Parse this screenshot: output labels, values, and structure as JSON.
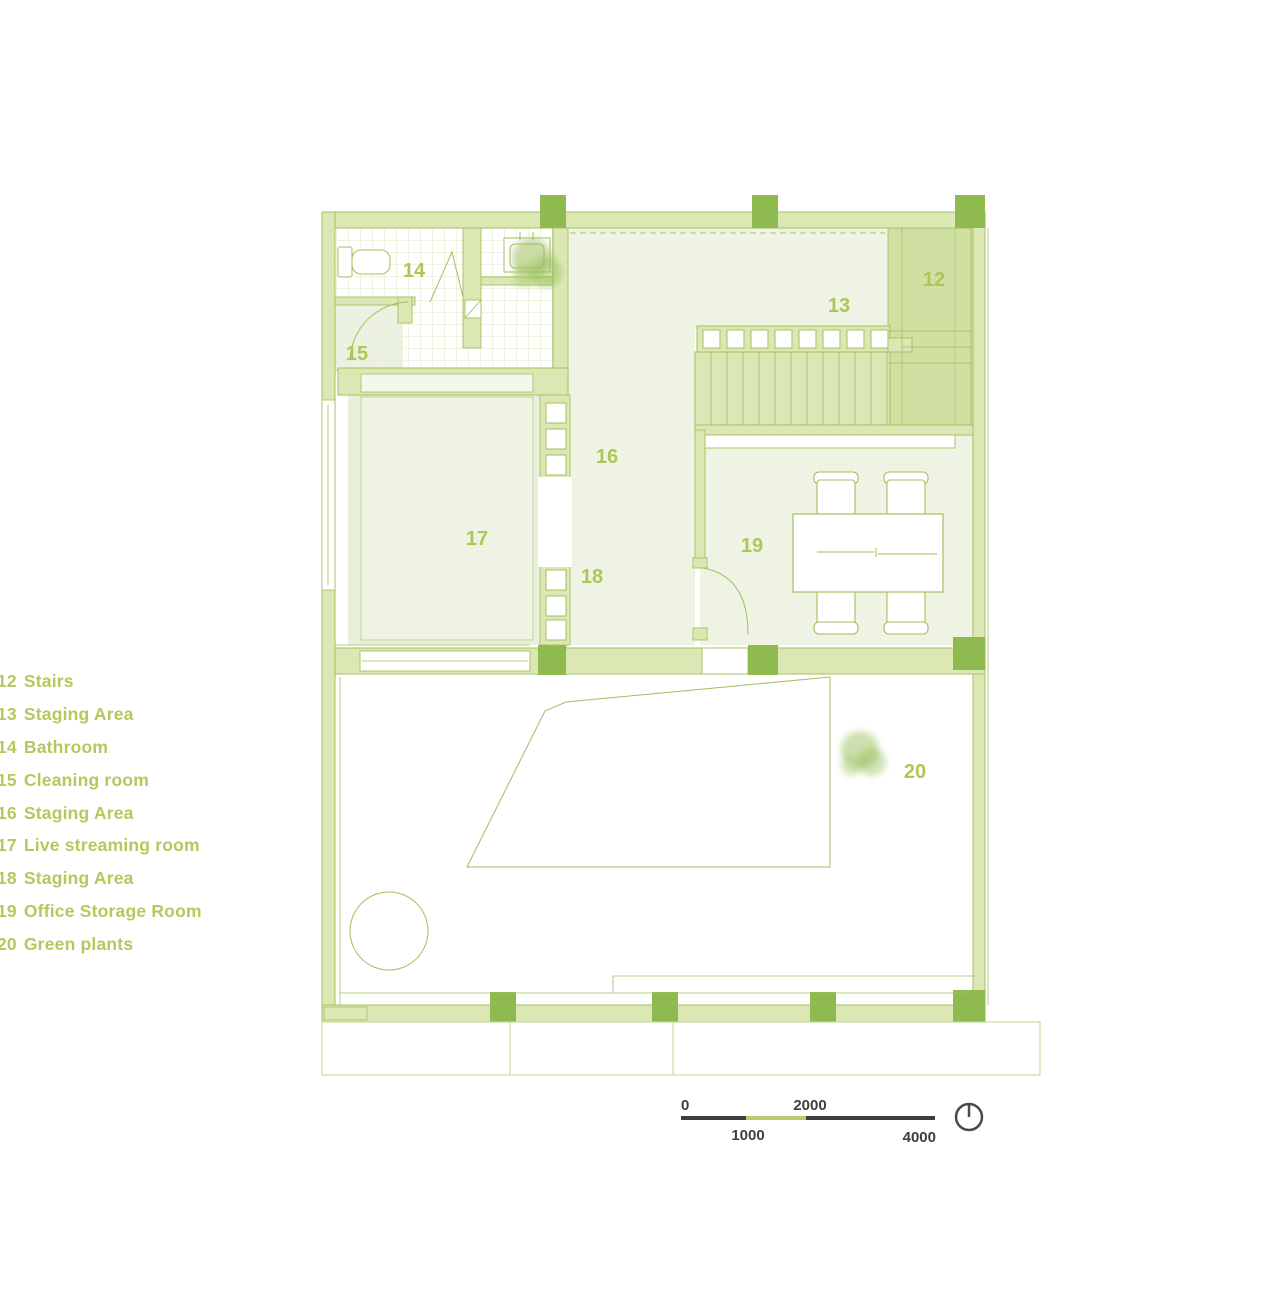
{
  "legend": {
    "items": [
      {
        "number": "12",
        "label": "Stairs"
      },
      {
        "number": "13",
        "label": "Staging Area"
      },
      {
        "number": "14",
        "label": "Bathroom"
      },
      {
        "number": "15",
        "label": "Cleaning room"
      },
      {
        "number": "16",
        "label": "Staging Area"
      },
      {
        "number": "17",
        "label": "Live streaming room"
      },
      {
        "number": "18",
        "label": "Staging Area"
      },
      {
        "number": "19",
        "label": "Office Storage Room"
      },
      {
        "number": "20",
        "label": "Green plants"
      }
    ]
  },
  "plan": {
    "room_labels": [
      {
        "id": "12"
      },
      {
        "id": "13"
      },
      {
        "id": "14"
      },
      {
        "id": "15"
      },
      {
        "id": "16"
      },
      {
        "id": "17"
      },
      {
        "id": "18"
      },
      {
        "id": "19"
      },
      {
        "id": "20"
      }
    ],
    "icons": {
      "compass": "north-indicator-circle",
      "trees": "plan-tree-blob",
      "toilet": "toilet-plan-symbol",
      "sink": "sink-plan-symbol",
      "table": "meeting-table-with-chairs"
    }
  },
  "scale_bar": {
    "start": "0",
    "mid_top": "2000",
    "mid_bottom": "1000",
    "end": "4000"
  },
  "colors": {
    "column_dark": "#8eba4f",
    "wall_fill": "#dce8b4",
    "line_green": "#a3bf5f",
    "room_tint": "#eef3e4",
    "stairs_fill": "#cfe0a2",
    "legend_text": "#b2c95e",
    "scale_dark": "#3e3e3e",
    "scale_green": "#b7cd6e",
    "tree_green": "#9cc05c"
  }
}
